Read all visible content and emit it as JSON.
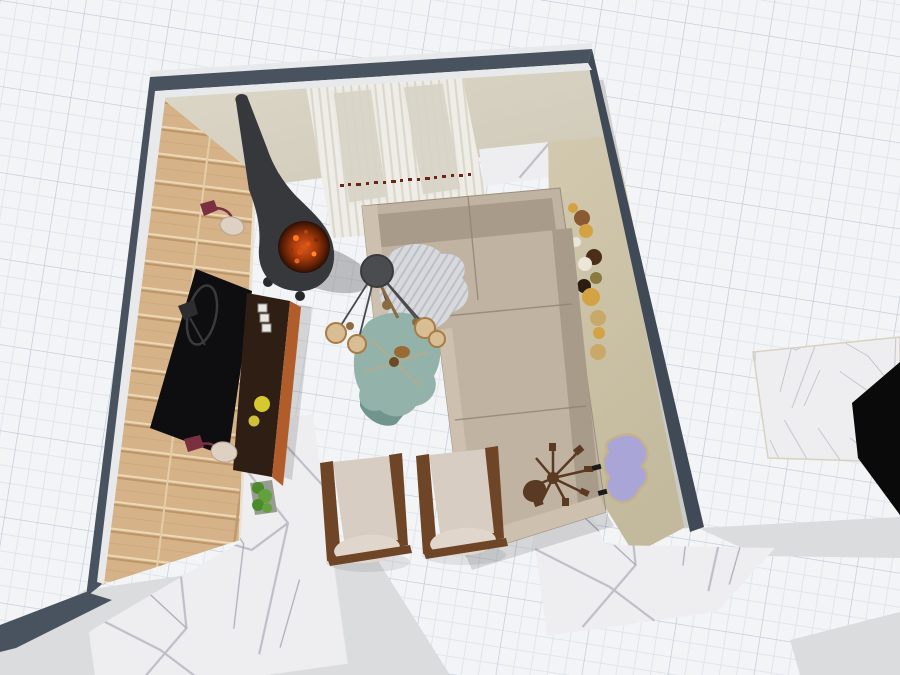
{
  "app": {
    "name": "3d-home-design-viewer",
    "view_mode": "3D top-down room view",
    "canvas": {
      "width": 900,
      "height": 675
    }
  },
  "grid": {
    "style": "graph-paper",
    "minor_spacing_px": 17,
    "major_spacing_px": 85
  },
  "palette": {
    "gridBg": "#f3f4f6",
    "gridMinor": "#e0e5ed",
    "gridMajor": "#bdc8d9",
    "wallSlate": "#49535f",
    "wallSlateDark": "#404a56",
    "crown": "#e8e9eb",
    "woodBase": "#d5b288",
    "plaster": "#d9d3c4",
    "plasterDeep": "#cfc9b8",
    "curtainBase": "#efede7",
    "curtainStripe": "#d7d3c7",
    "windowPane": "#d9d5c9",
    "windowFrame": "#eceae3",
    "curtainDots": "#6e2418",
    "beigeFloor": "#ccc3a8",
    "baseboard": "#cbccce",
    "marbleBase": "#eeedf0",
    "marbleVein": "#b9b9c2",
    "exteriorGray": "#dbdcdd",
    "sofaBase": "#c0b3a2",
    "sofaCushion": "#a89b8a",
    "sofaSeam": "#8f8474",
    "sofaArm": "#cdc0af",
    "throwBase": "#d8d9dc",
    "throwStripe": "#b6bac4",
    "lampShade": "#4b4c4f",
    "brass": "#8a6b42",
    "bulbGlass": "#d9bd93",
    "tableTeal": "#93b3aa",
    "tableTealDark": "#6f958d",
    "consoleTop": "#2f1e13",
    "consoleSide": "#b05d2b",
    "tvBlack": "#0e0e10",
    "chairFrame": "#6f4527",
    "chairCushion": "#d8cdc2",
    "fireplaceBlack": "#36383b",
    "rugLilac": "#a9a6d7",
    "rugBorder": "#c4b28c",
    "sputnikBrown": "#5a3a23",
    "plateAmber": "#d2a243",
    "plateBrown": "#8a5a32",
    "plateCream": "#ece6d8",
    "plateDark": "#2a1d10",
    "plateOlive": "#8a7a42",
    "plateGold": "#c9a96a",
    "plantGreen": "#4c8a2c",
    "plantGreenLight": "#63a13c",
    "plantTray": "#979b90",
    "blackSlab": "#0a0a0b",
    "sconcePlum": "#7a3040",
    "sconceShade": "#ded0c2"
  },
  "scene": {
    "room": "living room",
    "objects": [
      {
        "name": "grid-paper-background",
        "kind": "workspace"
      },
      {
        "name": "room-walls",
        "kind": "walls",
        "color": "#49535f"
      },
      {
        "name": "wood-accent-wall",
        "kind": "wall-finish",
        "color": "#d5b288"
      },
      {
        "name": "back-wall-curtains",
        "kind": "curtain",
        "color": "#efede7"
      },
      {
        "name": "window",
        "count": 2
      },
      {
        "name": "wall-plates-decor",
        "count": 12
      },
      {
        "name": "marble-floor",
        "color": "#eeedf0"
      },
      {
        "name": "beige-carpet-strip",
        "color": "#ccc3a8"
      },
      {
        "name": "cone-fireplace",
        "color": "#36383b"
      },
      {
        "name": "corner-sofa",
        "color": "#c0b3a2"
      },
      {
        "name": "throw-blanket",
        "color": "#d8d9dc"
      },
      {
        "name": "floor-lamp",
        "color": "#4b4c4f"
      },
      {
        "name": "sputnik-chandelier",
        "color": "#8a6b42"
      },
      {
        "name": "coffee-table",
        "color": "#93b3aa"
      },
      {
        "name": "tv-console",
        "color": "#2f1e13"
      },
      {
        "name": "tv-panel",
        "color": "#0e0e10"
      },
      {
        "name": "arc-floor-lamp",
        "color": "#3a3a3c"
      },
      {
        "name": "wall-sconce",
        "count": 2,
        "color": "#7a3040"
      },
      {
        "name": "armchair",
        "count": 2,
        "color": "#d8cdc2"
      },
      {
        "name": "starburst-decor",
        "color": "#5a3a23"
      },
      {
        "name": "area-rug",
        "color": "#a9a6d7"
      },
      {
        "name": "plant-tray",
        "color": "#4c8a2c"
      },
      {
        "name": "side-marble-slab",
        "color": "#eeedf0"
      },
      {
        "name": "black-countertop",
        "color": "#0a0a0b"
      }
    ]
  }
}
